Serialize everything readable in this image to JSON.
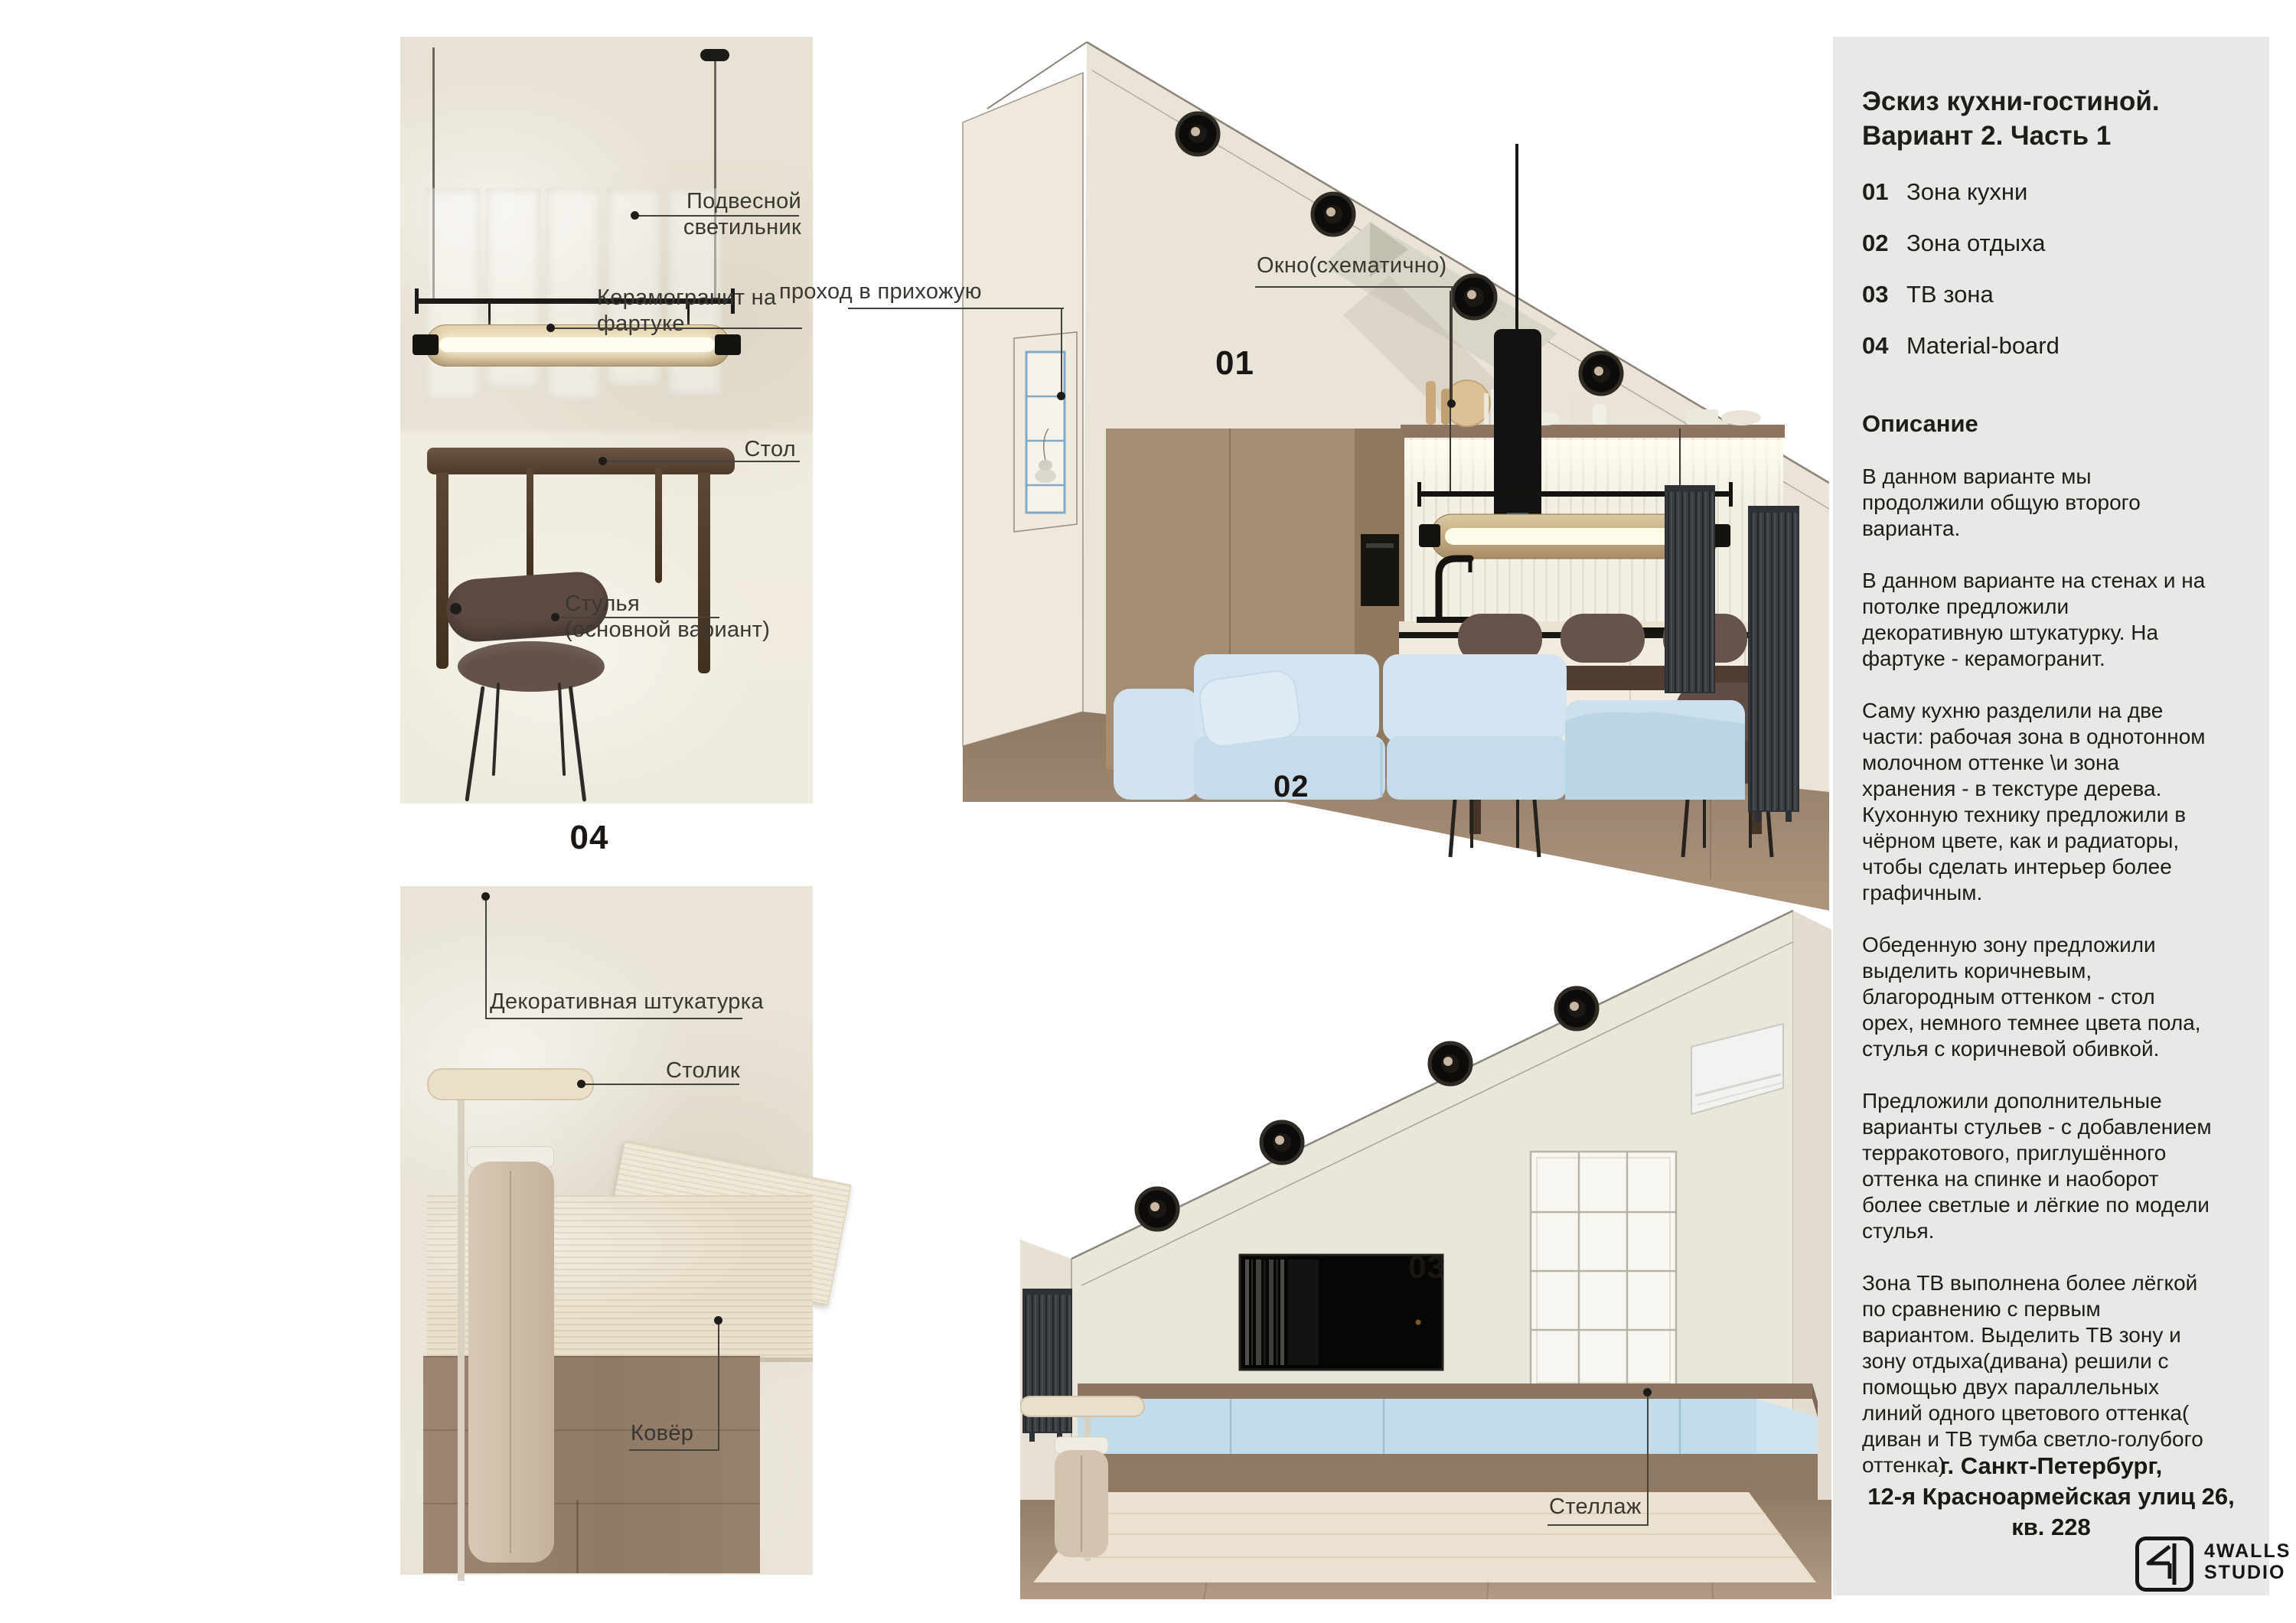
{
  "sidebar": {
    "title_line1": "Эскиз кухни-гостиной.",
    "title_line2": "Вариант 2. Часть 1",
    "zones": [
      {
        "num": "01",
        "label": "Зона кухни"
      },
      {
        "num": "02",
        "label": "Зона отдыха"
      },
      {
        "num": "03",
        "label": "ТВ зона"
      },
      {
        "num": "04",
        "label": "Material-board"
      }
    ],
    "description_heading": "Описание",
    "paragraphs": [
      "В данном варианте мы\nпродолжили общую второго\nварианта.",
      "В данном варианте на стенах и на\nпотолке предложили\nдекоративную штукатурку. На\nфартуке - керамогранит.",
      "Саму кухню разделили на две\nчасти: рабочая зона в однотонном\nмолочном оттенке \\и зона\nхранения - в текстуре дерева.\nКухонную технику предложили в\nчёрном цвете, как и радиаторы,\nчтобы сделать интерьер более\nграфичным.",
      "Обеденную зону предложили\nвыделить коричневым,\nблагородным оттенком - стол\nорех, немного темнее цвета пола,\nстулья с коричневой обивкой.",
      "Предложили дополнительные\nварианты стульев - с добавлением\nтерракотового, приглушённого\nоттенка на спинке и наоборот\nболее светлые и лёгкие по модели\nстулья.",
      "Зона ТВ выполнена более лёгкой\nпо сравнению с первым\nвариантом. Выделить ТВ зону и\nзону отдыха(дивана) решили с\nпомощью двух параллельных\nлиний одного цветового оттенка(\nдиван и ТВ тумба светло-голубого\nоттенка)"
    ],
    "address_line1": "г. Санкт-Петербург,",
    "address_line2": "12-я Красноармейская улиц 26,",
    "address_line3": "кв. 228",
    "logo_line1": "4WALLS",
    "logo_line2": "STUDIO"
  },
  "board_top": {
    "number": "04",
    "labels": {
      "pendant": "Подвесной\nсветильник",
      "ceramic": "Керамогранит на\nфартуке",
      "table": "Стол",
      "chairs": "Стулья\n(основной вариант)"
    }
  },
  "board_bottom": {
    "labels": {
      "plaster": "Декоративная штукатурка",
      "side_table": "Столик",
      "carpet": "Ковёр"
    }
  },
  "render_top": {
    "zone_kitchen": "01",
    "zone_sofa": "02",
    "labels": {
      "window": "Окно(схематично)",
      "hallway": "проход в прихожую"
    }
  },
  "render_bottom": {
    "zone_tv": "03",
    "labels": {
      "shelving": "Стеллаж"
    }
  },
  "colors": {
    "sidebar_bg": "#e9e8e6",
    "panel_bg": "#e9e4d7",
    "accent_blue": "#bcd8e8",
    "sofa_blue": "#cfe3f0",
    "wood": "#a28a72",
    "dark": "#1c1a17"
  }
}
